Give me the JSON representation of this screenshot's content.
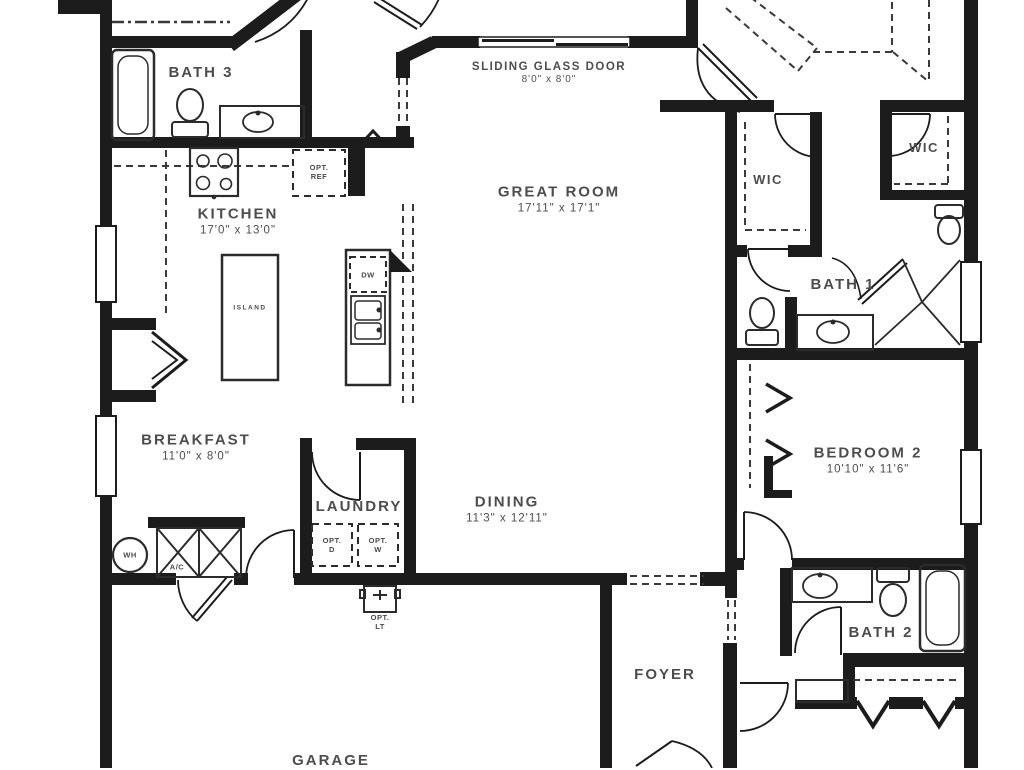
{
  "plan": {
    "title": "single story floor plan",
    "colors": {
      "wall": "#1c1c1c",
      "text": "#4d4d4d",
      "fixture": "#2b2b2b",
      "background": "#ffffff"
    },
    "rooms": [
      {
        "id": "bath-3",
        "name": "BATH 3",
        "dims": ""
      },
      {
        "id": "kitchen",
        "name": "KITCHEN",
        "dims": "17'0\" x 13'0\""
      },
      {
        "id": "great-room",
        "name": "GREAT ROOM",
        "dims": "17'11\" x 17'1\""
      },
      {
        "id": "wic-1",
        "name": "WIC",
        "dims": ""
      },
      {
        "id": "wic-2",
        "name": "WIC",
        "dims": ""
      },
      {
        "id": "bath-1",
        "name": "BATH 1",
        "dims": ""
      },
      {
        "id": "breakfast",
        "name": "BREAKFAST",
        "dims": "11'0\" x 8'0\""
      },
      {
        "id": "laundry",
        "name": "LAUNDRY",
        "dims": ""
      },
      {
        "id": "dining",
        "name": "DINING",
        "dims": "11'3\" x 12'11\""
      },
      {
        "id": "bedroom-2",
        "name": "BEDROOM 2",
        "dims": "10'10\" x 11'6\""
      },
      {
        "id": "bath-2",
        "name": "BATH 2",
        "dims": ""
      },
      {
        "id": "foyer",
        "name": "FOYER",
        "dims": ""
      },
      {
        "id": "garage",
        "name": "GARAGE",
        "dims": ""
      }
    ],
    "sliding_door": {
      "name": "SLIDING GLASS DOOR",
      "dims": "8'0\" x 8'0\""
    },
    "fixtures": {
      "opt_ref": "OPT.\nREF",
      "dw": "DW",
      "island": "ISLAND",
      "wh": "WH",
      "ac": "A/C",
      "opt_d": "OPT.\nD",
      "opt_w": "OPT.\nW",
      "opt_lt": "OPT.\nLT"
    }
  }
}
